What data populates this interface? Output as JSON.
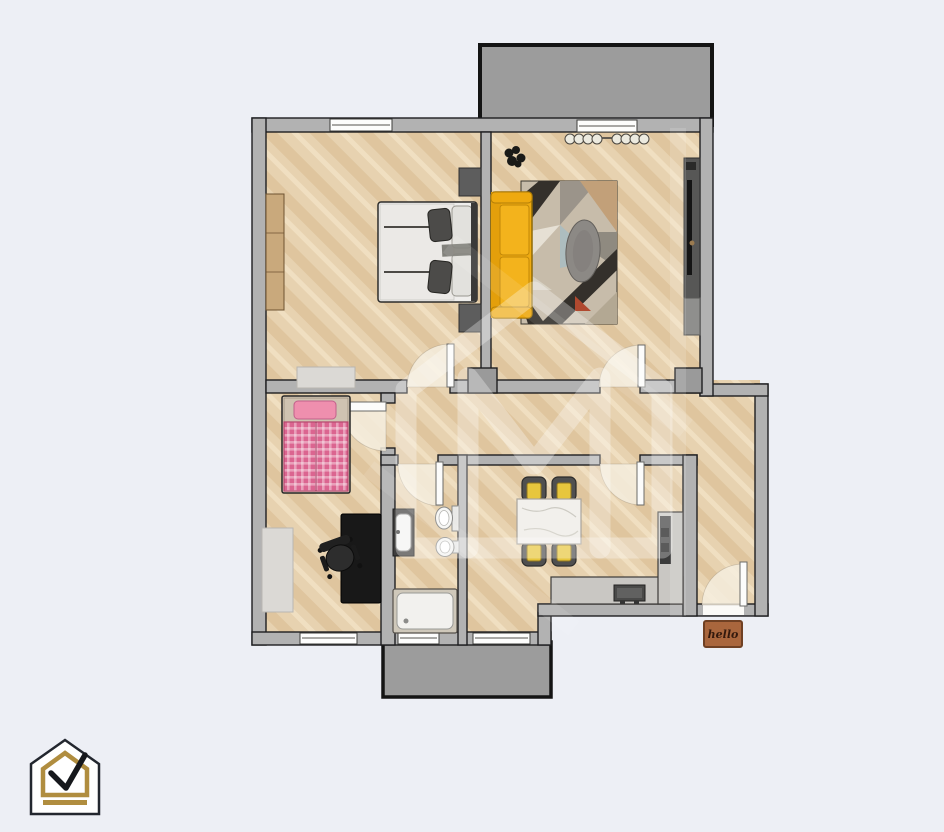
{
  "meta": {
    "canvas_width": 944,
    "canvas_height": 832,
    "description": "Top-down 2D rendered floor plan of an apartment with two balconies, watermark house logo, company logo bottom-left"
  },
  "colors": {
    "background": "#edeff5",
    "wall": "#b2b2b2",
    "wall_stroke": "#1e1e20",
    "floor_base": "#e7d2b0",
    "floor_stripe": "#d8b98f",
    "floor_light": "#f2e3c7",
    "balcony_floor": "#9c9c9c",
    "door_leaf": "#fcfcfb",
    "door_arc": "#f6efdf",
    "sofa_yellow": "#efab11",
    "rug_dark": "#34302b",
    "bed_pink": "#db6590",
    "neutral_rug": "#dbd9d5",
    "counter_gray": "#c9c7c3",
    "desk_black": "#181818",
    "marble_white": "#f2f0ec",
    "cushion_yellow": "#e7c63d",
    "doormat_brown": "#a9663d",
    "logo_gold": "#b08d3f",
    "logo_outline": "#23272f",
    "watermark_white": "rgba(255,255,255,0.30)"
  },
  "doormat": {
    "text": "hello"
  },
  "diagram_content": {
    "type": "floorplan",
    "rooms": [
      {
        "name": "bedroom-main",
        "position": "top-left",
        "furniture": [
          "wardrobe",
          "double-bed",
          "two-nightstands",
          "rug"
        ]
      },
      {
        "name": "living-room",
        "position": "top-right",
        "furniture": [
          "yellow-sofa",
          "patterned-rug",
          "gray-pouf",
          "tv-unit",
          "plant",
          "curtained-window"
        ]
      },
      {
        "name": "bedroom-second",
        "position": "bottom-left",
        "furniture": [
          "pink-single-bed",
          "black-desk",
          "office-chair",
          "rug"
        ]
      },
      {
        "name": "bathroom",
        "position": "bottom-center",
        "furniture": [
          "washbasin",
          "toilet",
          "bidet",
          "shower-tray"
        ]
      },
      {
        "name": "kitchen",
        "position": "bottom-right",
        "furniture": [
          "dining-table",
          "four-chairs",
          "l-shaped-counter",
          "appliances"
        ]
      },
      {
        "name": "hallway-entry",
        "position": "right",
        "furniture": []
      },
      {
        "name": "balcony-top",
        "position": "top",
        "furniture": []
      },
      {
        "name": "balcony-bottom",
        "position": "bottom",
        "furniture": []
      }
    ],
    "doors": 6,
    "windows": 5
  }
}
